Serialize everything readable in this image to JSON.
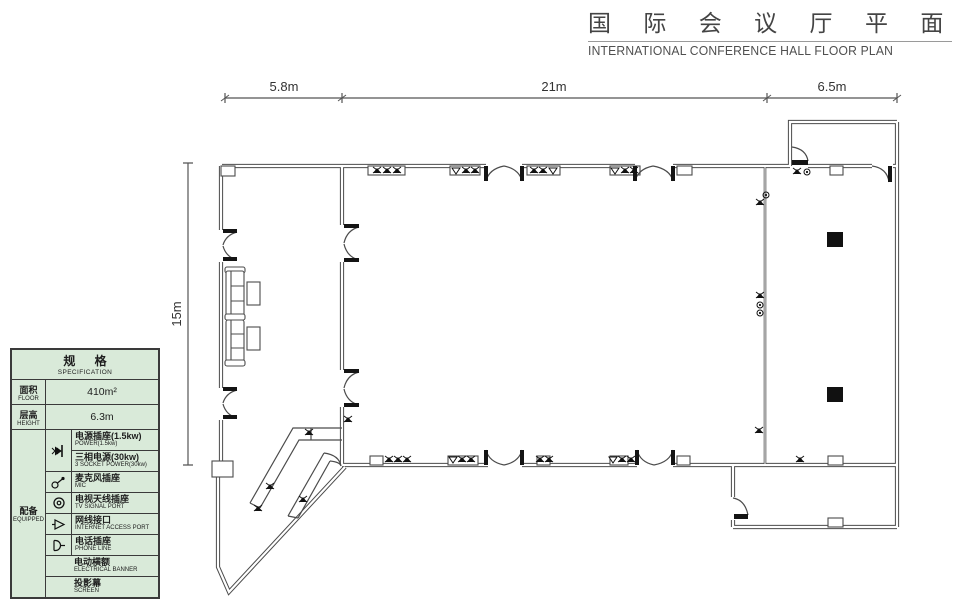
{
  "title": {
    "zh": "国 际 会 议 厅 平 面 图",
    "en": "INTERNATIONAL CONFERENCE HALL FLOOR PLAN"
  },
  "dimensions": {
    "top_left": "5.8m",
    "top_middle": "21m",
    "top_right": "6.5m",
    "left": "15m"
  },
  "spec_table": {
    "header": {
      "zh": "规 格",
      "en": "SPECIFICATION"
    },
    "floor": {
      "label_zh": "面积",
      "label_en": "FLOOR",
      "value": "410m²"
    },
    "height": {
      "label_zh": "层高",
      "label_en": "HEIGHT",
      "value": "6.3m"
    },
    "equipped": {
      "label_zh": "配备",
      "label_en": "EQUIPPED",
      "items": [
        {
          "icon": "power-socket-icon",
          "zh": "电源插座(1.5kw)",
          "en": "POWER(1.5kw)"
        },
        {
          "icon": "power-socket-icon",
          "zh": "三相电源(30kw)",
          "en": "3 SOCKET POWER(30kw)"
        },
        {
          "icon": "mic-icon",
          "zh": "麦克风插座",
          "en": "MIC"
        },
        {
          "icon": "tv-icon",
          "zh": "电视天线插座",
          "en": "TV SIGNAL PORT"
        },
        {
          "icon": "internet-icon",
          "zh": "网线接口",
          "en": "INTERNET ACCESS PORT"
        },
        {
          "icon": "phone-icon",
          "zh": "电话插座",
          "en": "PHONE LINE"
        },
        {
          "icon": null,
          "zh": "电动横额",
          "en": "ELECTRICAL BANNER"
        },
        {
          "icon": null,
          "zh": "投影幕",
          "en": "SCREEN"
        }
      ]
    }
  },
  "colors": {
    "line": "#4b4b4b",
    "door_leaf": "#141414",
    "table_bg": "#d9ead9",
    "title_text": "#444444"
  }
}
